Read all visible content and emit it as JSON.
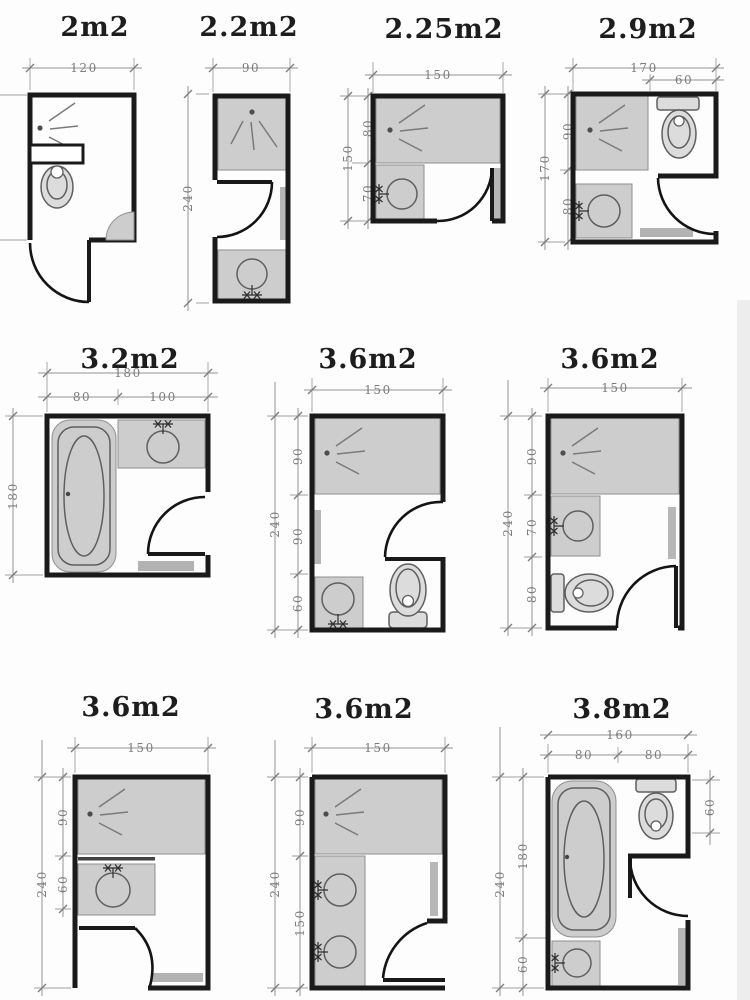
{
  "colors": {
    "wall": "#1a1a1a",
    "floor_zone": "#cdcdcd",
    "radiator": "#b7b7b7",
    "dimension_line": "#8f8f8f",
    "dimension_text": "#7c7c7c",
    "background": "#ffffff"
  },
  "plans": [
    {
      "id": "p1",
      "title": "2m2",
      "dims": {
        "width": "120"
      }
    },
    {
      "id": "p2",
      "title": "2.2m2",
      "dims": {
        "width": "90",
        "height": "240"
      }
    },
    {
      "id": "p3",
      "title": "2.25m2",
      "dims": {
        "width": "150",
        "height": "150",
        "top": "80",
        "bottom": "70"
      }
    },
    {
      "id": "p4",
      "title": "2.9m2",
      "dims": {
        "width": "170",
        "toilet": "60",
        "height": "170",
        "top": "90",
        "bottom": "80"
      }
    },
    {
      "id": "p5",
      "title": "3.2m2",
      "dims": {
        "width": "180",
        "left": "80",
        "right": "100",
        "height": "180"
      }
    },
    {
      "id": "p6",
      "title": "3.6m2",
      "dims": {
        "width": "150",
        "height": "240",
        "top": "90",
        "mid": "90",
        "bottom": "60"
      }
    },
    {
      "id": "p7",
      "title": "3.6m2",
      "dims": {
        "width": "150",
        "height": "240",
        "top": "90",
        "mid": "70",
        "bottom": "80"
      }
    },
    {
      "id": "p8",
      "title": "3.6m2",
      "dims": {
        "width": "150",
        "height": "240",
        "top": "90",
        "mid": "60"
      }
    },
    {
      "id": "p9",
      "title": "3.6m2",
      "dims": {
        "width": "150",
        "height": "240",
        "top": "90",
        "mid": "150"
      }
    },
    {
      "id": "p10",
      "title": "3.8m2",
      "dims": {
        "width": "160",
        "left": "80",
        "right": "80",
        "height": "240",
        "bath": "180",
        "sink": "60",
        "toilet": "60"
      }
    }
  ]
}
